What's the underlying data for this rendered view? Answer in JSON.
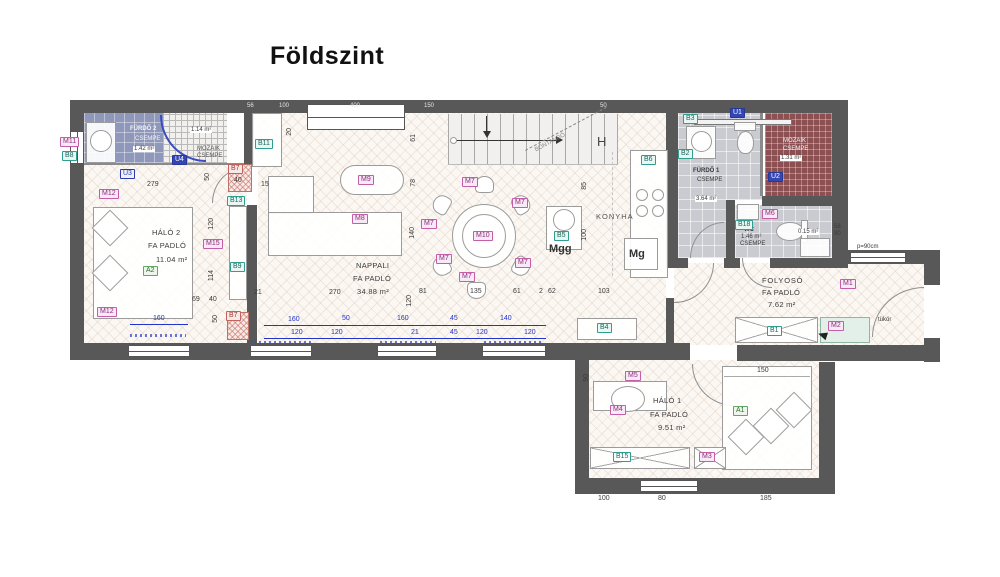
{
  "title": "Földszint",
  "rooms": {
    "furdo2": {
      "name": "FÜRDŐ 2",
      "floor": "CSEMPE",
      "area": "1.42 m²",
      "shower_area": "1.14 m²",
      "shower_tile1": "MOZAIK",
      "shower_tile2": "CSEMPE"
    },
    "halo2": {
      "name": "HÁLÓ 2",
      "floor": "FA PADLÓ",
      "area": "11.04 m²"
    },
    "nappali": {
      "name": "NAPPALI",
      "floor": "FA PADLÓ",
      "area": "34.88 m²"
    },
    "konyha": {
      "name": "KONYHA"
    },
    "furdo1": {
      "name": "FÜRDŐ 1",
      "floor": "CSEMPE",
      "area": "3.64 m²",
      "shower_tile1": "MOZAIK",
      "shower_tile2": "CSEMPE",
      "shower_area": "1.31 m²"
    },
    "wc": {
      "name": "WC",
      "floor": "CSEMPE",
      "area": "1.46 m²",
      "niche_area": "0.15 m²"
    },
    "folyoso": {
      "name": "FOLYOSÓ",
      "floor": "FA PADLÓ",
      "area": "7.62 m²"
    },
    "halo1": {
      "name": "HÁLÓ 1",
      "floor": "FA PADLÓ",
      "area": "9.51 m²"
    }
  },
  "annotations": {
    "mgg": "Mgg",
    "mg": "Mg",
    "h": "H",
    "tukor": "tükör",
    "parapet": "p=90cm",
    "stair_note": "BONTANDÓ"
  },
  "tags": {
    "m1": "M1",
    "m2": "M2",
    "m3": "M3",
    "m4": "M4",
    "m5": "M5",
    "m6": "M6",
    "m7": "M7",
    "m8": "M8",
    "m9": "M9",
    "m10": "M10",
    "m11": "M11",
    "m12": "M12",
    "m15": "M15",
    "b1": "B1",
    "b2": "B2",
    "b3": "B3",
    "b4": "B4",
    "b5": "B5",
    "b6": "B6",
    "b7": "B7",
    "b8": "B8",
    "b9": "B9",
    "b11": "B11",
    "b13": "B13",
    "b15": "B15",
    "b18": "B18",
    "u1": "U1",
    "u2": "U2",
    "u3": "U3",
    "u4": "U4",
    "a1": "A1",
    "a2": "A2"
  },
  "dims": {
    "t56": "56",
    "t100": "100",
    "t400": "400",
    "t150": "150",
    "t50": "50",
    "f2w": "279",
    "f2_50": "50",
    "f2_40": "40",
    "f2_15": "15",
    "f2_20": "20",
    "h2_120": "120",
    "h2_114": "114",
    "h2_69": "69",
    "h2_40": "40",
    "h2_50": "50",
    "h2_160": "160",
    "n61": "61",
    "n78": "78",
    "n140": "140",
    "n120": "120",
    "r21": "21",
    "r270": "270",
    "r81": "81",
    "r135": "135",
    "r61": "61",
    "r2": "2",
    "r62": "62",
    "r103": "103",
    "k85": "85",
    "k100": "100",
    "b160a": "160",
    "b50": "50",
    "b160b": "160",
    "b45a": "45",
    "b140": "140",
    "c120a": "120",
    "c120b": "120",
    "c21": "21",
    "c45": "45",
    "c120c": "120",
    "c120d": "120",
    "h1_150": "150",
    "h1_90": "90",
    "h1_100": "100",
    "h1_80": "80",
    "h1_185": "185",
    "fol58": "58",
    "fol90": "90"
  }
}
